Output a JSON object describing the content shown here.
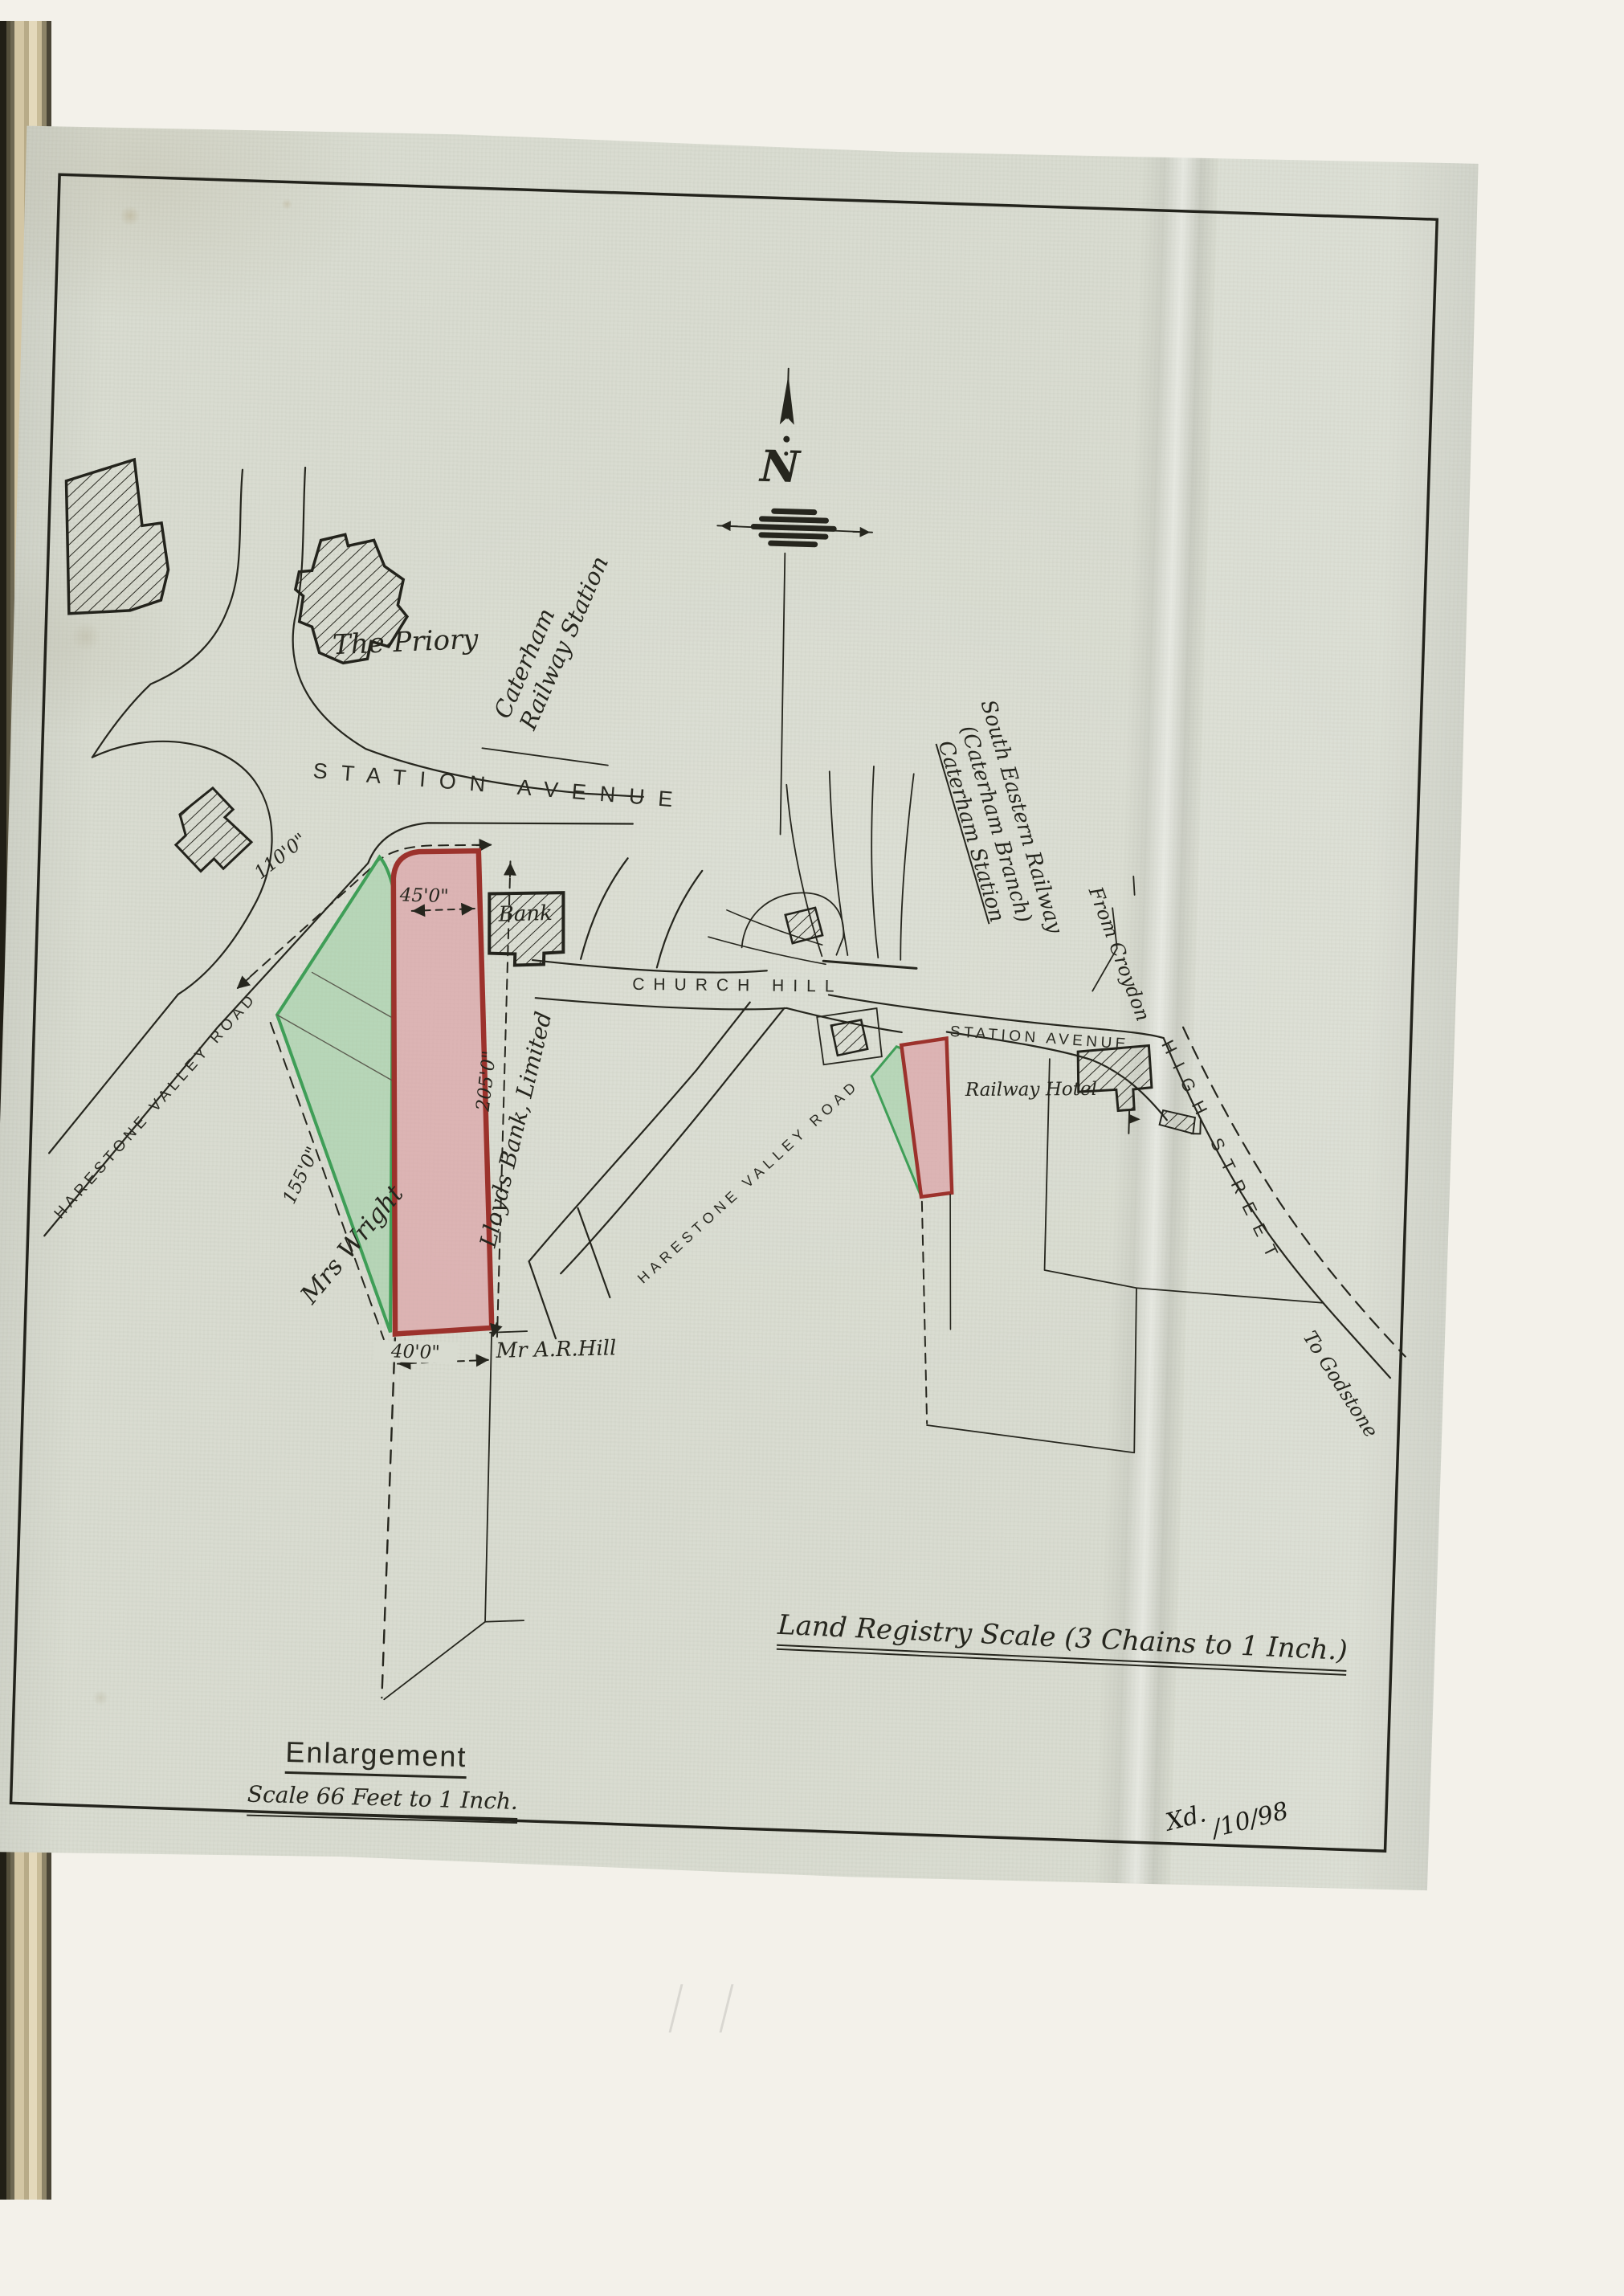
{
  "sheet": {
    "north_mark": "N",
    "scale_note": "Land Registry Scale (3 Chains to 1 Inch.)",
    "examined": {
      "mark": "Xd.",
      "date": "/10/98"
    },
    "enlargement": {
      "title": "Enlargement",
      "scale": "Scale 66 Feet to 1 Inch.",
      "labels": {
        "priory": "The Priory",
        "station_avenue": "STATION AVENUE",
        "railway_station": [
          "Caterham",
          "Railway Station"
        ],
        "harestone_valley_road": "HARESTONE VALLEY ROAD",
        "bank": "Bank",
        "lloyds": "Lloyds Bank, Limited",
        "mrs_wright": "Mrs Wright",
        "mr_hill": "Mr A.R.Hill"
      },
      "dimensions": {
        "road_frontage": "110'0\"",
        "north_width": "45'0\"",
        "east_side": "205'0\"",
        "west_side": "155'0\"",
        "south_width": "40'0\""
      }
    },
    "location_map": {
      "labels": {
        "church_hill": "CHURCH HILL",
        "station_avenue": "STATION AVENUE",
        "harestone_valley_road": "HARESTONE VALLEY ROAD",
        "high_street": "HIGH STREET",
        "railway": [
          "South Eastern Railway",
          "(Caterham Branch)",
          "Caterham Station"
        ],
        "from_croydon": "From Croydon",
        "to_godstone": "To Godstone",
        "railway_hotel": "Railway Hotel"
      }
    },
    "colors": {
      "parcel_pink": "#dda4a8",
      "parcel_pink_border": "#9c322c",
      "parcel_green": "#9ad0a2",
      "parcel_green_border": "#3f9e57",
      "ink": "#26261e",
      "paper": "#d9dcd1"
    }
  }
}
